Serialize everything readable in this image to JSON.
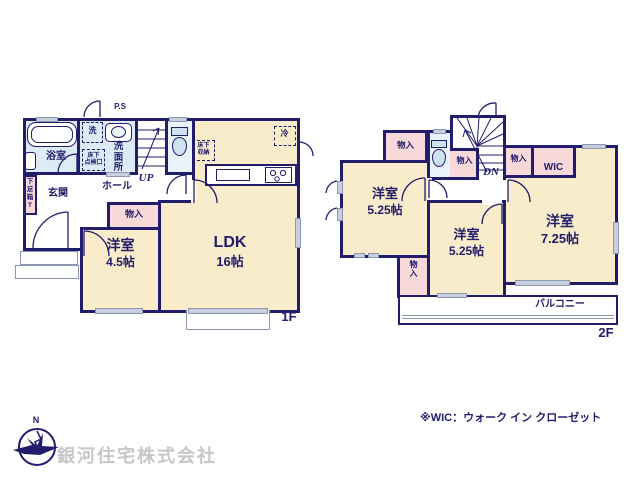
{
  "colors": {
    "wall_navy": "#211c6b",
    "room_cream": "#f8ecca",
    "closet_pink": "#f8d9da",
    "bath_blue": "#dcebf6",
    "toilet_blue": "#eaf2fa",
    "window_gray": "#c9cfdf",
    "company_gray": "#c6c6cb"
  },
  "f1": {
    "floor": "1F",
    "ps": "P.S",
    "bath": "浴室",
    "washer": "洗",
    "washroom": "洗\n面\n所",
    "hatch": "床下\n点検口",
    "storage": "床下\n収納",
    "fridge": "冷",
    "up": "UP",
    "hall": "ホール",
    "entrance": "玄関",
    "shoe_box": "下\n足\n箱\nT",
    "closet": "物入",
    "west": {
      "name": "洋室",
      "size": "4.5帖"
    },
    "ldk": {
      "name": "LDK",
      "size": "16帖"
    }
  },
  "f2": {
    "floor": "2F",
    "closet_tl": "物入",
    "closet_under_stairs": "物入",
    "closet_mid": "物入",
    "wic": "WIC",
    "dn": "DN",
    "west_a": {
      "name": "洋室",
      "size": "5.25帖"
    },
    "west_b": {
      "name": "洋室",
      "size": "5.25帖"
    },
    "west_c": {
      "name": "洋室",
      "size": "7.25帖"
    },
    "closet_bl": "物\n入",
    "balcony": "バルコニー"
  },
  "footer": {
    "note": "※WIC：ウォーク イン クローゼット",
    "company": "銀河住宅株式会社",
    "compass_north": "N"
  }
}
